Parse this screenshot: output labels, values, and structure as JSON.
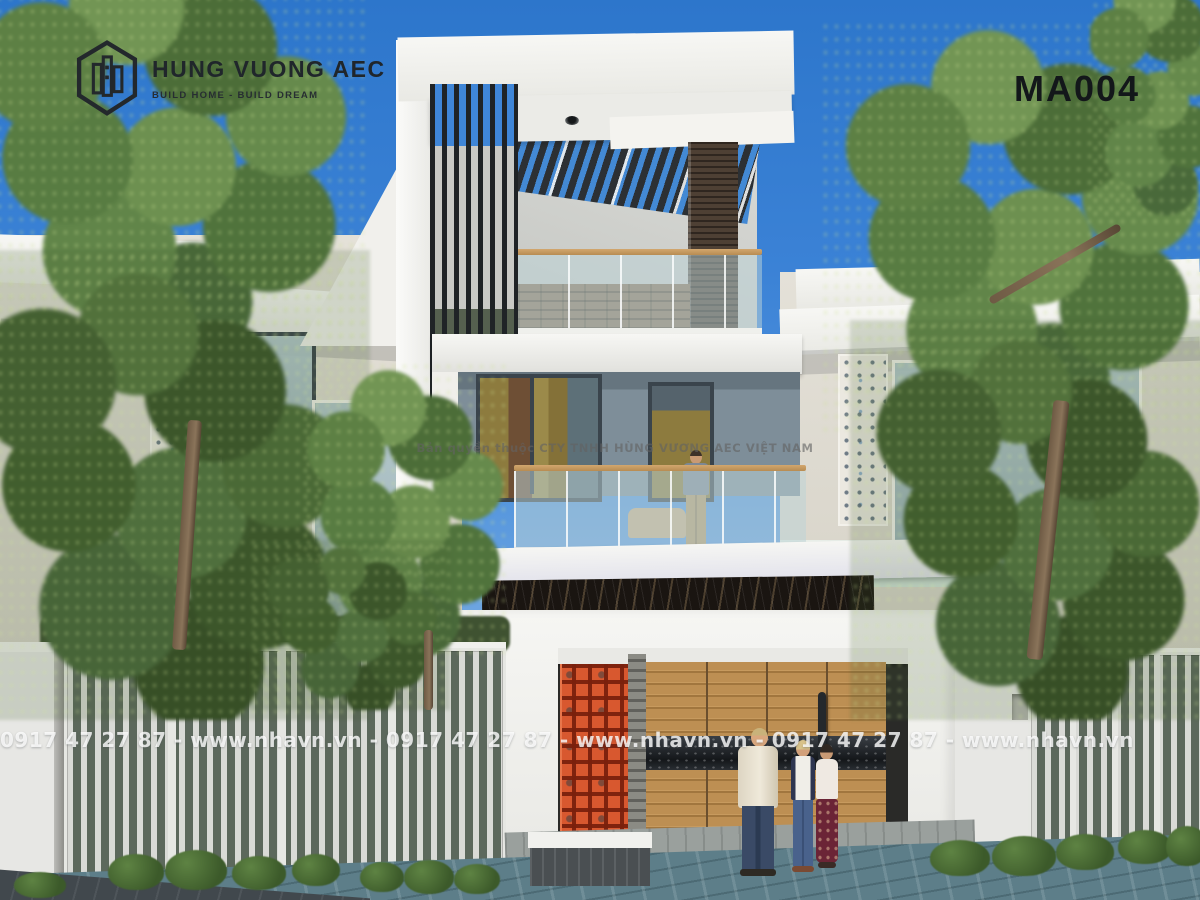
{
  "branding": {
    "logo_title": "HUNG VUONG AEC",
    "logo_tagline": "BUILD HOME - BUILD DREAM",
    "logo_icon": "hexagon-buildings-icon"
  },
  "design_code": "MA004",
  "watermarks": {
    "contact_repeat": "0917 47 27 87 - www.nhavn.vn - 0917 47 27 87 - www.nhavn.vn - 0917 47 27 87 - www.nhavn.vn",
    "copyright": "Bản quyền thuộc CTY TNHH HÙNG VƯƠNG AEC VIỆT NAM"
  },
  "palette": {
    "sky_top": "#2d76cb",
    "sky_horizon": "#b7d5ef",
    "wall_white": "#f5f5f2",
    "wall_cream": "#ddd9cf",
    "accent_orange": "#d8582f",
    "garage_wood": "#b5874b",
    "louver_dark": "#1f2326",
    "wood_column": "#4e4034",
    "second_floor_wall": "#7e8e99",
    "curtain_olive": "#8d7b3e",
    "marble_band": "#1a1511",
    "foliage_green": "#5d8044",
    "road_teal": "#5d7e89",
    "logo_text": "#20262b",
    "code_text": "#13171a",
    "watermark_white": "#ffffff",
    "watermark_gray": "#626262"
  }
}
